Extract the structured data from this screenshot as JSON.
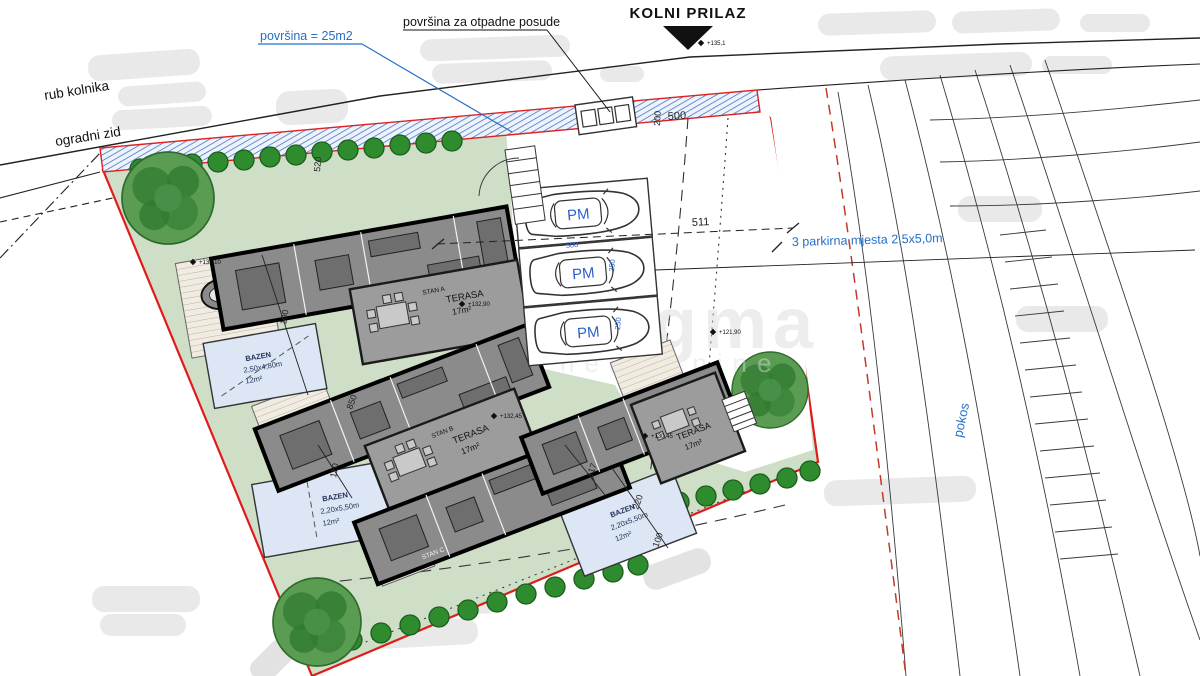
{
  "labels": {
    "title": "KOLNI PRILAZ",
    "waste_area": "površina za otpadne posude",
    "surface_area": "površina = 25m2",
    "road_edge": "rub kolnika",
    "fence_wall": "ogradni zid",
    "parking_note": "3 parkirna mjesta 2,5x5,0m",
    "slope": "pokos"
  },
  "watermark": {
    "main": "Dogma",
    "sub": "nekretnine"
  },
  "parking": {
    "stall_label": "PM",
    "stall_count": 3
  },
  "pools": [
    {
      "name": "BAZEN",
      "size": "2,50x4,80m",
      "area": "12m²"
    },
    {
      "name": "BAZEN",
      "size": "2,20x5,50m",
      "area": "12m²"
    },
    {
      "name": "BAZEN",
      "size": "2,20x5,50m",
      "area": "12m²"
    }
  ],
  "units": [
    {
      "name": "STAN A",
      "terrace": "TERASA",
      "terrace_area": "17m²"
    },
    {
      "name": "STAN B",
      "terrace": "TERASA",
      "terrace_area": "17m²"
    },
    {
      "name": "STAN C"
    },
    {
      "terrace": "TERASA",
      "terrace_area": "17m²"
    }
  ],
  "dimensions": {
    "d200": "200",
    "d500_top": "500",
    "d511": "511",
    "d500_stall": "500",
    "d250": "250",
    "d520": "520",
    "d100_deck": "100",
    "d850": "850",
    "d110": "110",
    "d117": "117",
    "d220": "220",
    "d100_hedge": "100"
  },
  "elevations": [
    "+135,1",
    "+132,90",
    "+132,45",
    "+130,45",
    "+131,10",
    "+121,90"
  ]
}
